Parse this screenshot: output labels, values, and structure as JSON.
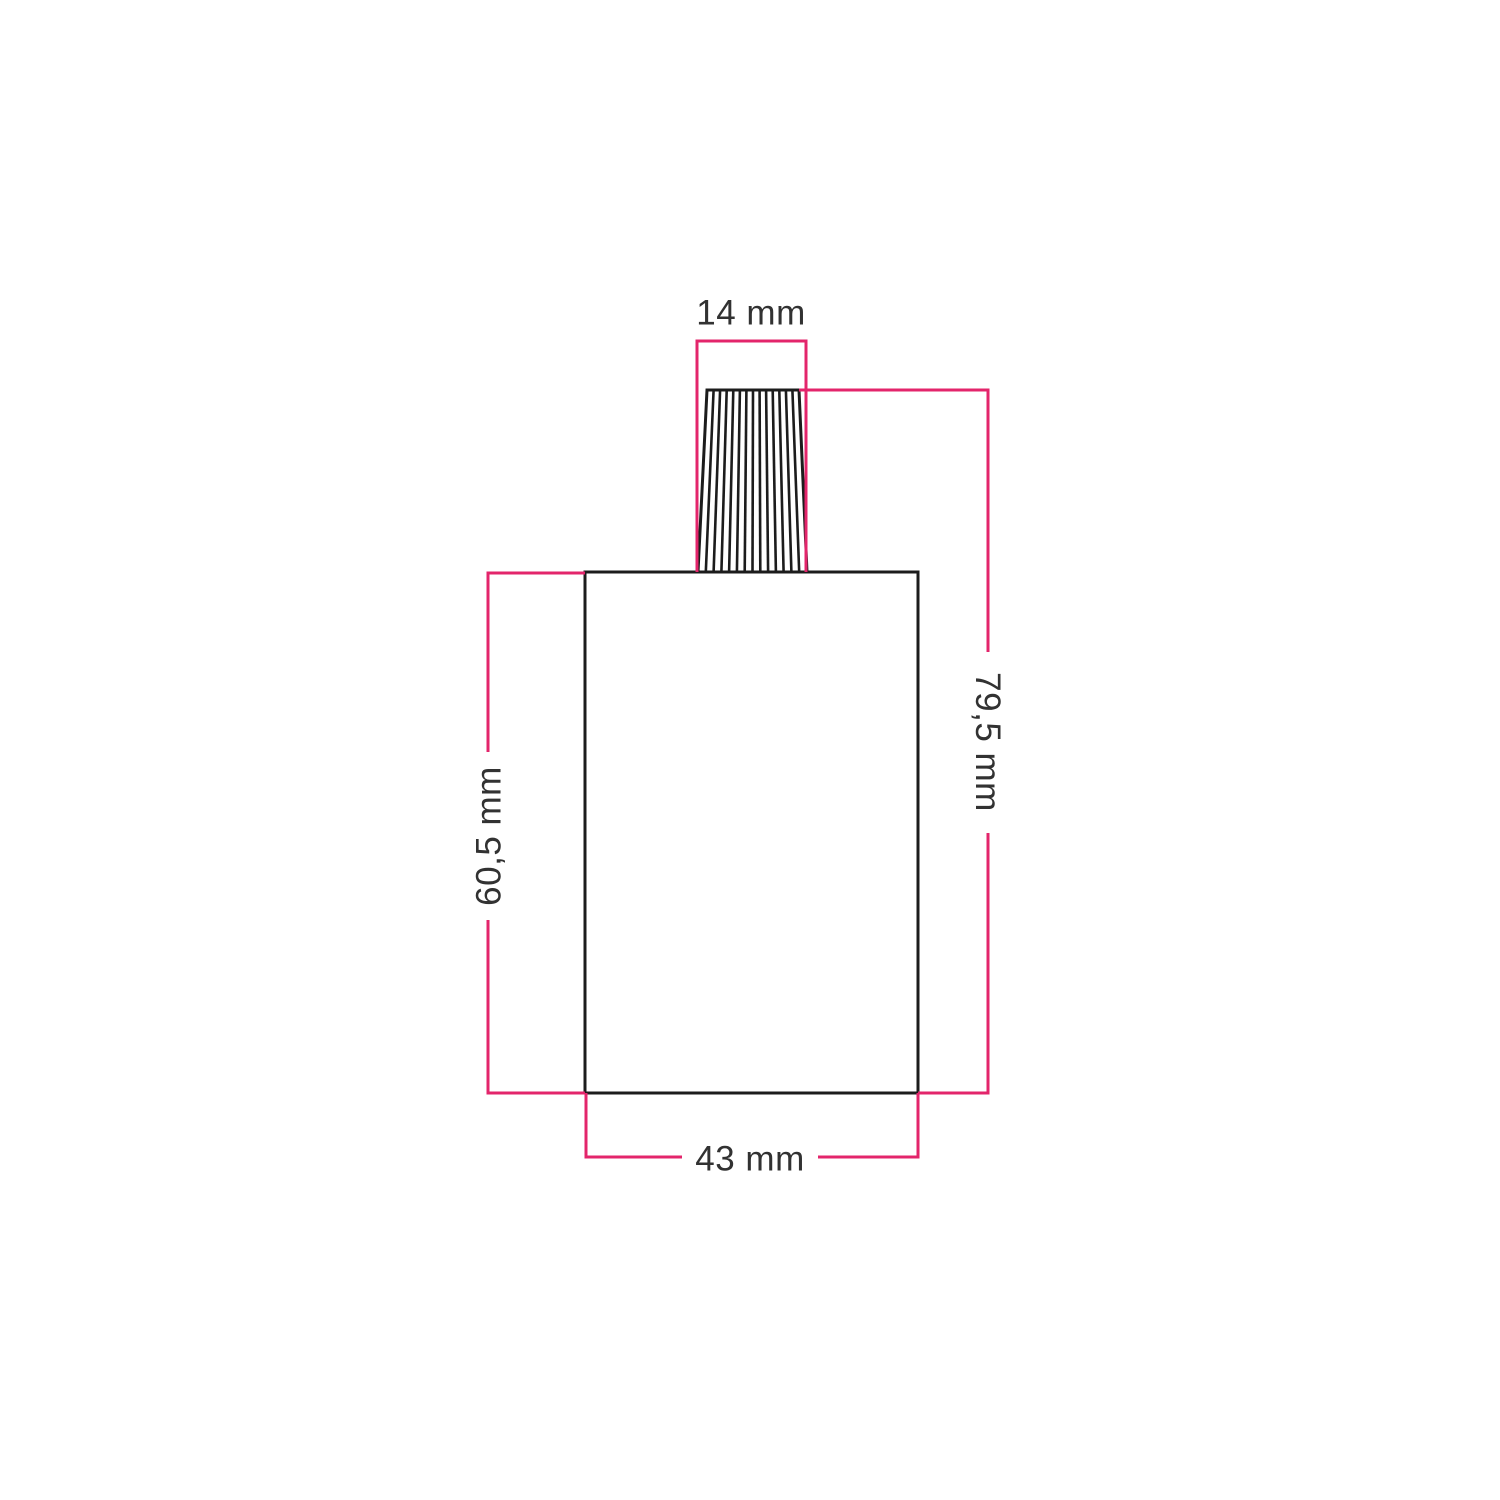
{
  "drawing": {
    "description": "Technical dimension drawing of a cylindrical lamp holder body with ribbed cable-grip cone on top",
    "dimensions": {
      "cone_top_width": {
        "label": "14 mm"
      },
      "total_height": {
        "label": "79,5 mm"
      },
      "body_height": {
        "label": "60,5 mm"
      },
      "body_width": {
        "label": "43 mm"
      }
    }
  },
  "colors": {
    "dimension_line": "#e3256b",
    "outline": "#1c1c1c",
    "label_text": "#323232",
    "background": "#ffffff"
  }
}
